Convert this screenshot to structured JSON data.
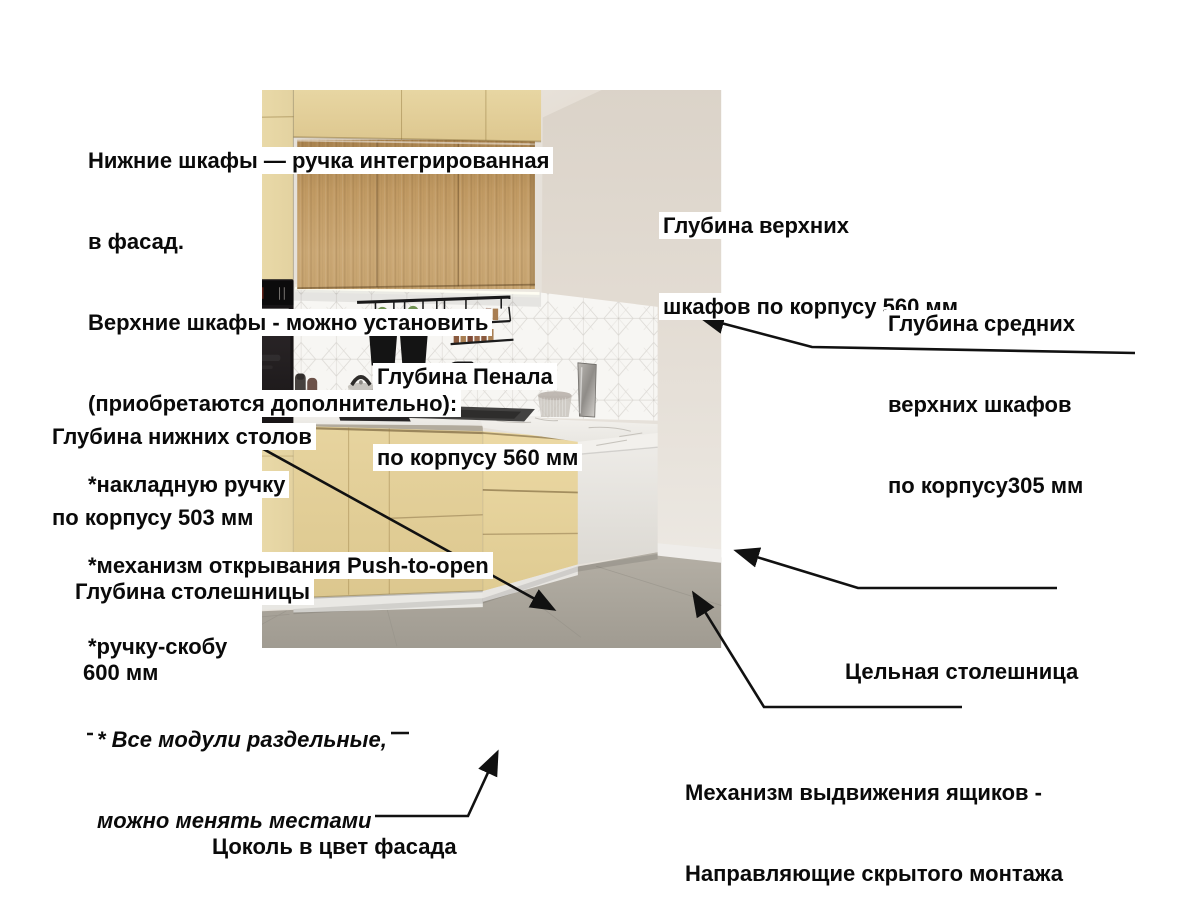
{
  "notes": {
    "handles": {
      "lines": [
        "Нижние шкафы — ручка интегрированная",
        "в фасад.",
        "Верхние шкафы - можно установить",
        "(приобретаются дополнительно):",
        "*накладную ручку",
        "*механизм открывания Push-to-open",
        "*ручку-скобу"
      ]
    },
    "modules": {
      "lines": [
        "* Все модули раздельные,",
        "можно менять местами"
      ]
    }
  },
  "labels": {
    "upper_cabinets_depth": {
      "lines": [
        "Глубина верхних",
        "шкафов по корпусу 560 мм"
      ]
    },
    "middle_upper_cabinets_depth": {
      "lines": [
        "Глубина средних",
        "верхних шкафов",
        "по корпусу305 мм"
      ]
    },
    "tall_cabinet_depth": {
      "lines": [
        "Глубина Пенала",
        "по корпусу 560 мм"
      ]
    },
    "base_cabinets_depth": {
      "lines": [
        "Глубина нижних столов",
        "по корпусу 503 мм"
      ]
    },
    "countertop_depth": {
      "lines": [
        "Глубина столешницы",
        "600 мм"
      ]
    },
    "solid_countertop": {
      "text": "Цельная столешница"
    },
    "drawer_mechanism": {
      "lines": [
        "Механизм выдвижения ящиков -",
        "Направляющие скрытого монтажа"
      ]
    },
    "plinth": {
      "text": "Цоколь в цвет фасада"
    }
  },
  "scene": {
    "oven_brand": "BOSCH",
    "colors": {
      "facade_yellow": "#e6d3a0",
      "wood_oak": "#c7a26b",
      "countertop_white": "#f0eeea",
      "annotation_text": "#0a0a0a",
      "label_background": "#ffffff",
      "arrow_color": "#111111"
    }
  }
}
